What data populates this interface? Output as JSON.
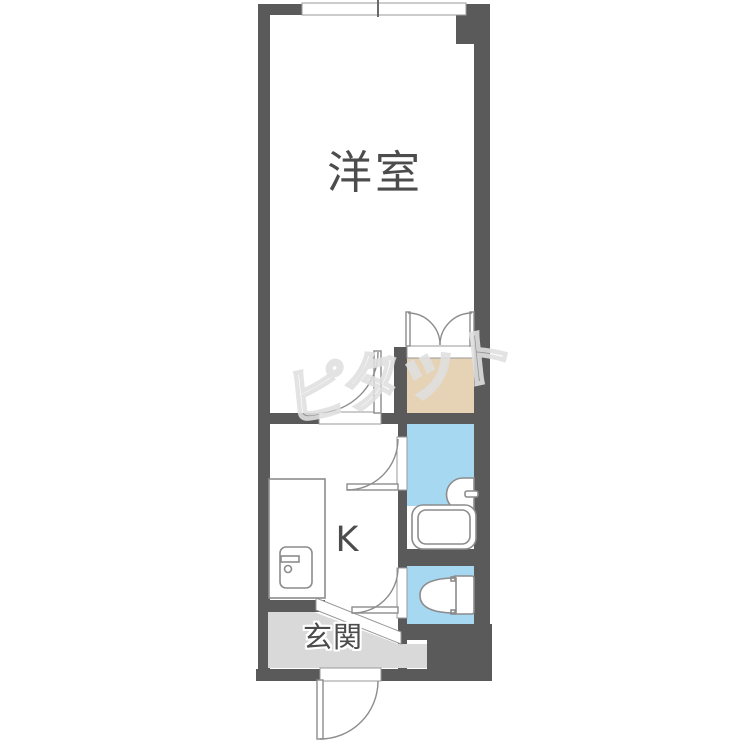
{
  "rooms": {
    "western": {
      "label": "洋室"
    },
    "kitchen": {
      "label": "K"
    },
    "entrance": {
      "label": "玄関"
    }
  },
  "watermark": {
    "text": "ピタット"
  },
  "colors": {
    "wall": "#5a5a5a",
    "water": "#a6d9f1",
    "closet": "#e6d2b4",
    "entrance": "#d9d9d9",
    "outline": "#8c8c8c",
    "label": "#4c4c4c",
    "watermark_stroke": "#e0e0e0"
  },
  "fixtures": [
    "window",
    "closet-double-door",
    "room-door",
    "kitchen-counter",
    "kitchen-sink",
    "bathroom-door",
    "washbasin",
    "bathtub",
    "toilet-door",
    "toilet",
    "entrance-step",
    "front-door"
  ]
}
